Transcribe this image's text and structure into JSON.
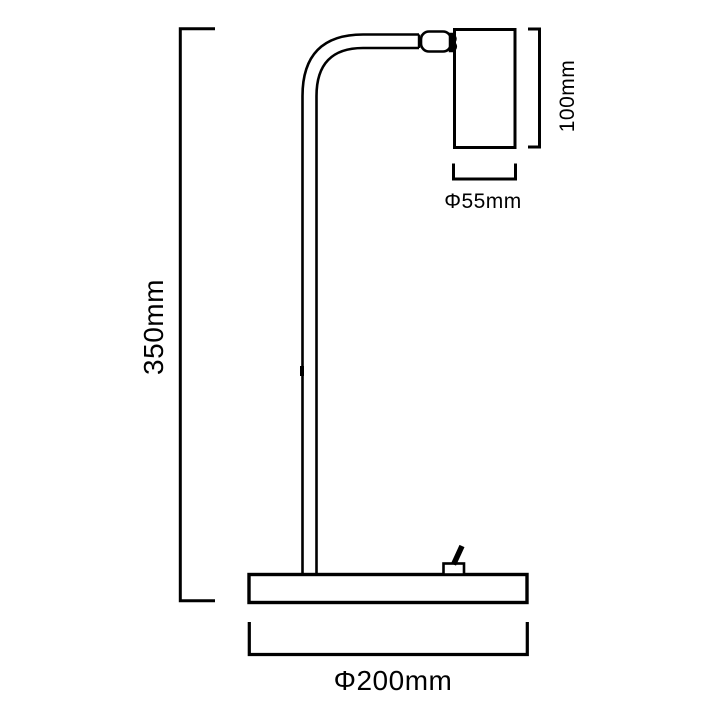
{
  "diagram": {
    "type": "lamp-dimension-drawing",
    "colors": {
      "line": "#000000",
      "background": "#ffffff"
    },
    "labels": {
      "overall_height": "350mm",
      "head_height": "100mm",
      "head_diameter": "Φ55mm",
      "base_diameter": "Φ200mm"
    }
  }
}
